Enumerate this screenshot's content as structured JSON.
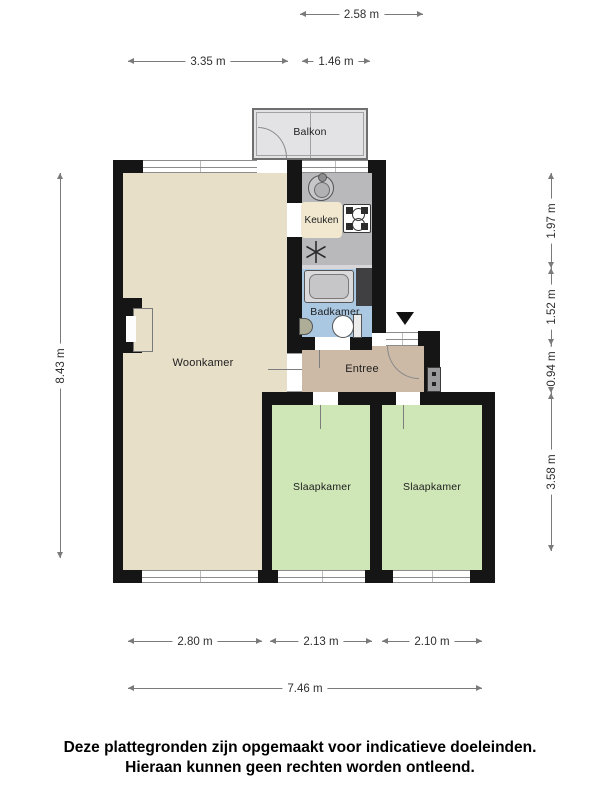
{
  "plan": {
    "rooms": {
      "balkon": {
        "label": "Balkon"
      },
      "keuken": {
        "label": "Keuken"
      },
      "badkamer": {
        "label": "Badkamer"
      },
      "woonkamer": {
        "label": "Woonkamer"
      },
      "entree": {
        "label": "Entree"
      },
      "slaapkamer_left": {
        "label": "Slaapkamer"
      },
      "slaapkamer_right": {
        "label": "Slaapkamer"
      }
    },
    "dimensions": {
      "top_balcony": "2.58 m",
      "top_left": "3.35 m",
      "top_right": "1.46 m",
      "left_total": "8.43 m",
      "right_keuken": "1.97 m",
      "right_badkamer": "1.52 m",
      "right_entree": "0.94 m",
      "right_slaapkamer": "3.58 m",
      "bottom_woonkamer": "2.80 m",
      "bottom_slaapkamer_left": "2.13 m",
      "bottom_slaapkamer_right": "2.10 m",
      "bottom_total": "7.46 m"
    },
    "icons": {
      "kitchen_sink": "round-basin-with-tap",
      "stove": "four-burner-hob",
      "boiler": "asterisk-symbol",
      "bathtub": "rounded-tub",
      "toilet": "bowl-with-cistern",
      "washbasin": "half-oval-basin",
      "entrance_marker": "down-triangle",
      "meter_box": "wall-unit"
    },
    "colors": {
      "wall": "#151515",
      "woonkamer_floor": "#e7dfc8",
      "slaapkamer_floor": "#cfe6b7",
      "entree_floor": "#ccbaa6",
      "badkamer_floor": "#aac8e2",
      "keuken_floor": "#b9b9bb",
      "balkon_floor": "#e3e3e5",
      "keuken_label_bg": "#f1e8cf"
    }
  },
  "disclaimer": {
    "line1": "Deze plattegronden zijn opgemaakt voor indicatieve doeleinden.",
    "line2": "Hieraan kunnen geen rechten worden ontleend."
  }
}
